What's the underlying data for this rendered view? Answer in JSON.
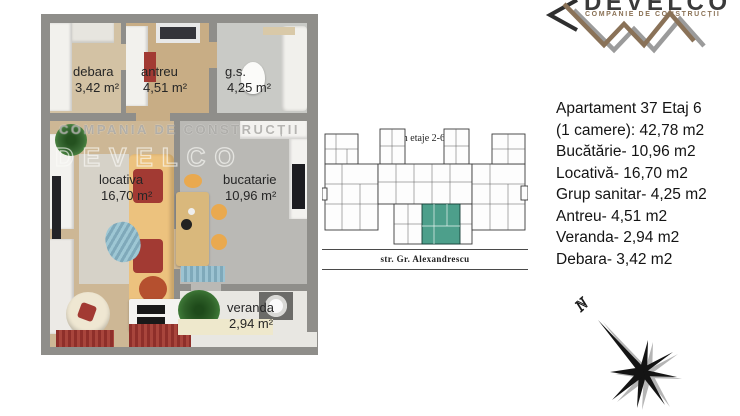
{
  "logo": {
    "name": "DEVELCO",
    "tagline": "COMPANIE DE CONSTRUCȚII"
  },
  "floorplan": {
    "watermark1": "COMPANIA DE CONSTRUCȚII",
    "watermark2": "DEVELCO",
    "rooms": [
      {
        "id": "debara",
        "label": "debara",
        "area": "3,42 m²"
      },
      {
        "id": "antreu",
        "label": "antreu",
        "area": "4,51 m²"
      },
      {
        "id": "gs",
        "label": "g.s.",
        "area": "4,25 m²"
      },
      {
        "id": "locativa",
        "label": "locativa",
        "area": "16,70 m²"
      },
      {
        "id": "bucatarie",
        "label": "bucatarie",
        "area": "10,96 m²"
      },
      {
        "id": "veranda",
        "label": "veranda",
        "area": "2,94 m²"
      }
    ]
  },
  "siteplan": {
    "title": "Plan etaje 2-6",
    "street": "str. Gr. Alexandrescu",
    "highlight_color": "#4d9f8b"
  },
  "details": {
    "lines": [
      "Apartament 37 Etaj 6",
      "(1 camere): 42,78 m2",
      "Bucătărie- 10,96 m2",
      "Locativă- 16,70 m2",
      "Grup sanitar- 4,25 m2",
      "Antreu- 4,51 m2",
      "Veranda- 2,94 m2",
      "Debara- 3,42 m2"
    ]
  },
  "compass": {
    "n_label": "N"
  },
  "colors": {
    "wall": "#8f8e8a",
    "wood_floor": "#cdb795",
    "accent_teal": "#4d9f8b",
    "logo_brown": "#8a7258",
    "logo_gray": "#9b9b9b",
    "rug_red": "#8e2f2a",
    "sofa_yellow": "#ecc27e"
  }
}
